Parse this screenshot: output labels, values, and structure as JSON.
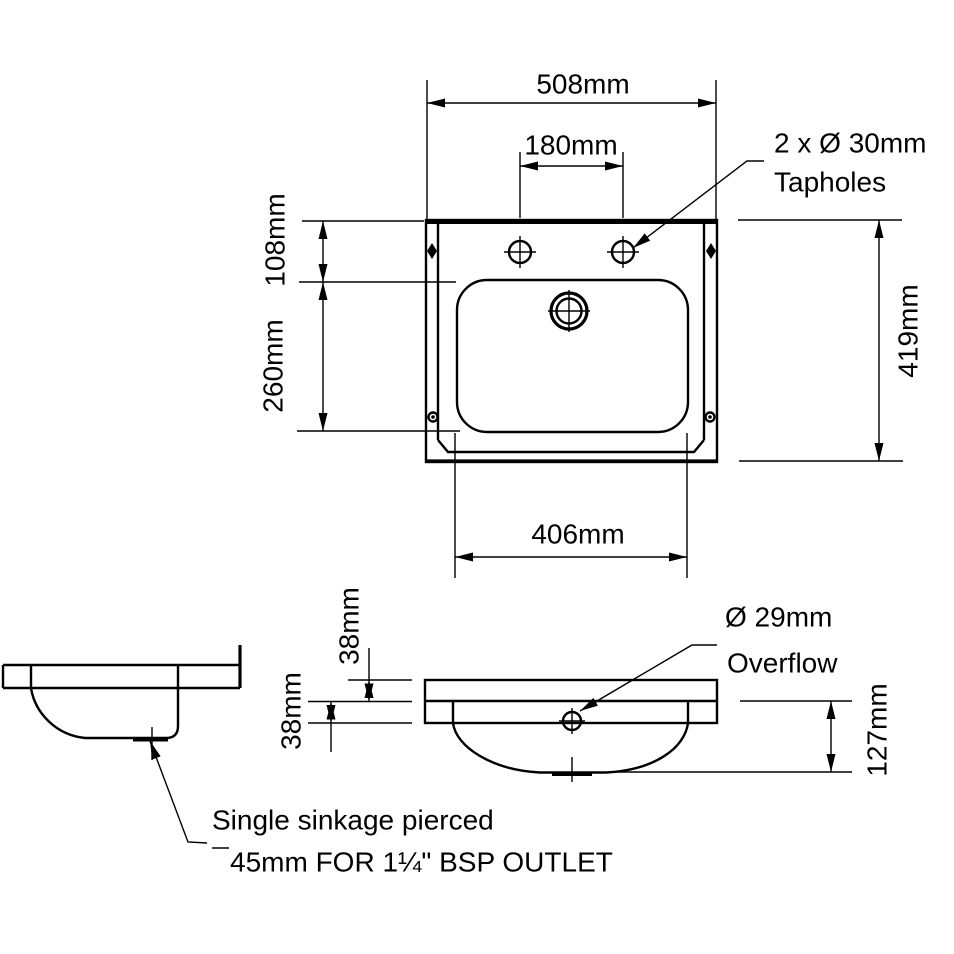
{
  "drawing": {
    "colors": {
      "line": "#000000",
      "background": "#ffffff"
    },
    "plan_view": {
      "overall_width": "508mm",
      "taphole_spacing": "180mm",
      "rim_to_bowl": "108mm",
      "bowl_length": "260mm",
      "overall_depth": "419mm",
      "bowl_width": "406mm",
      "tapholes_note": {
        "line1": "2 x Ø 30mm",
        "line2": "Tapholes"
      }
    },
    "section_view": {
      "rim_band_upper": "38mm",
      "rim_band_lower": "38mm",
      "bowl_depth": "127mm",
      "overflow_note": {
        "line1": "Ø 29mm",
        "line2": "Overflow"
      },
      "outlet_note": {
        "line1": "Single sinkage pierced",
        "line2": "45mm FOR 1¼\" BSP OUTLET"
      }
    }
  }
}
